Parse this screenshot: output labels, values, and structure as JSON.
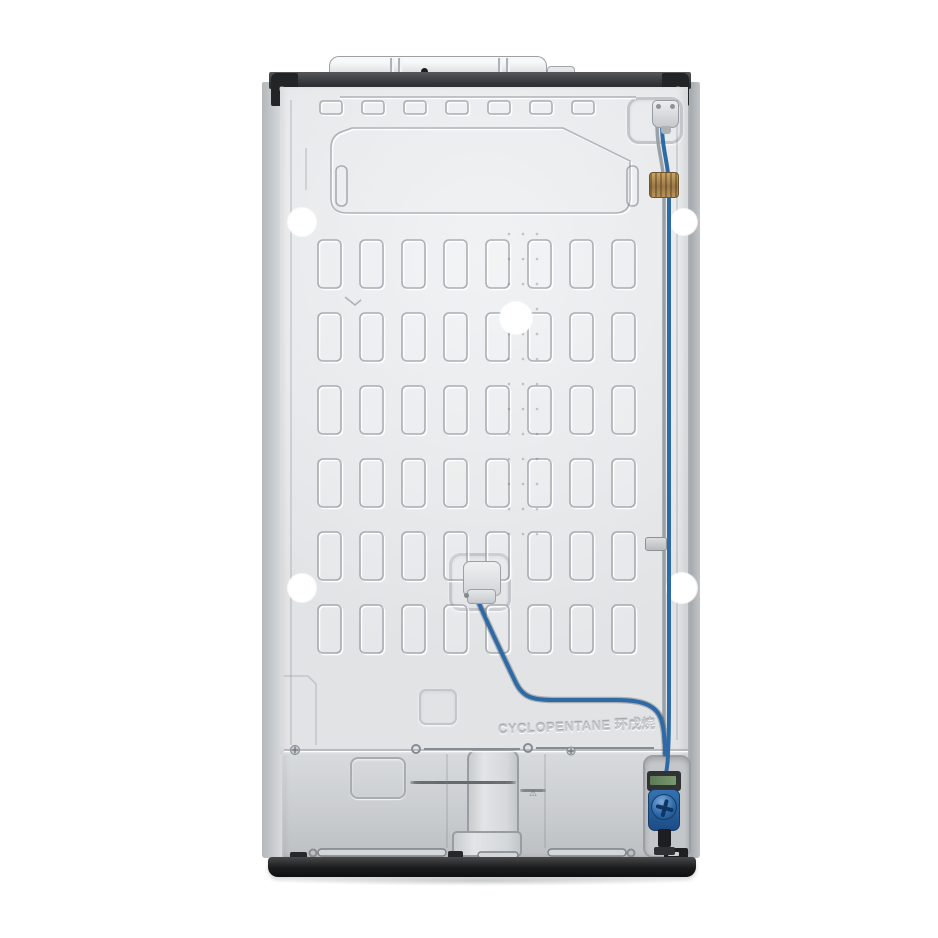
{
  "embossed_text": {
    "cyclopentane": "CYCLOPENTANE 环戊烷"
  },
  "icons": {
    "warning_icon": "⚠"
  },
  "colors": {
    "tube_blue": "#2e6aa6",
    "tube_gray": "#99a0a6",
    "brass": "#b8935a",
    "valve_blue": "#1c4c84",
    "base_black": "#1a1b1d",
    "grille_slot": "#1f2123",
    "hole_white": "#ffffff"
  },
  "embossing": {
    "grid": {
      "cols": 8,
      "rows": 6,
      "x0": 318,
      "y0": 240,
      "pitch_x": 42,
      "pitch_y": 73,
      "cell_w": 23,
      "cell_h": 48
    },
    "top_squares": {
      "count": 7,
      "x0": 320,
      "y": 101,
      "pitch": 42,
      "w": 22,
      "h": 13
    },
    "weld_dots": {
      "xs": [
        509,
        523,
        537
      ],
      "y0": 234,
      "pitch_y": 25,
      "count": 13
    },
    "holes": [
      {
        "cx": 302,
        "cy": 222,
        "r": 14
      },
      {
        "cx": 684,
        "cy": 222,
        "r": 13
      },
      {
        "cx": 516,
        "cy": 318,
        "r": 16
      },
      {
        "cx": 302,
        "cy": 588,
        "r": 14
      },
      {
        "cx": 682,
        "cy": 588,
        "r": 15
      }
    ]
  },
  "tubes": {
    "gray_path": "M 657 124 C 657 152 664 162 664 192 L 664 742",
    "blue_right_path": "M 662 124 C 662 152 669 162 669 192 L 669 700 C 669 726 669 740 668 752 C 668 768 665 780 661 792",
    "blue_center_path": "M 478 601 C 491 631 505 660 516 683 C 523 697 532 700 554 700 L 616 700 C 642 700 656 705 661 719 C 664 728 665 740 665 754"
  },
  "etched_labels": {
    "left_lines": [
      38,
      86,
      66,
      34,
      104,
      96,
      58,
      106,
      98,
      54,
      100,
      92
    ],
    "right_lines": [
      20,
      26,
      24
    ]
  }
}
